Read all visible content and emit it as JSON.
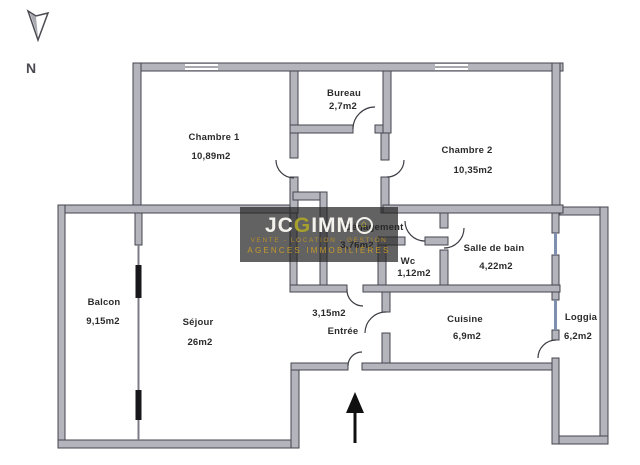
{
  "compass": {
    "label": "N"
  },
  "watermark": {
    "brand_jc": "JC",
    "brand_g": "G",
    "brand_imm": "IMM",
    "house_icon": "⌂",
    "tagline1": "VENTE - LOCATION - GESTION",
    "tagline2": "AGENCES IMMOBILIÈRES",
    "colors": {
      "background": "#282828",
      "logo_text": "#f3f2ec",
      "logo_olive": "#a7a02c",
      "gold": "#c59a2b"
    }
  },
  "plan_colors": {
    "wall_fill": "#b4b4bd",
    "wall_stroke": "#45454e",
    "window_blue": "#7e90ae",
    "black_frame": "#17171c"
  },
  "rooms": {
    "chambre1": {
      "name": "Chambre 1",
      "area": "10,89m2"
    },
    "bureau": {
      "name": "Bureau",
      "area": "2,7m2"
    },
    "chambre2": {
      "name": "Chambre 2",
      "area": "10,35m2"
    },
    "degagement": {
      "name": "Dégagement",
      "area": "3,76m2"
    },
    "wc": {
      "name": "Wc",
      "area": "1,12m2"
    },
    "salledebain": {
      "name": "Salle de bain",
      "area": "4,22m2"
    },
    "balcon": {
      "name": "Balcon",
      "area": "9,15m2"
    },
    "sejour": {
      "name": "Séjour",
      "area": "26m2"
    },
    "entree": {
      "name": "Entrée",
      "area": "3,15m2"
    },
    "cuisine": {
      "name": "Cuisine",
      "area": "6,9m2"
    },
    "loggia": {
      "name": "Loggia",
      "area": "6,2m2"
    }
  }
}
